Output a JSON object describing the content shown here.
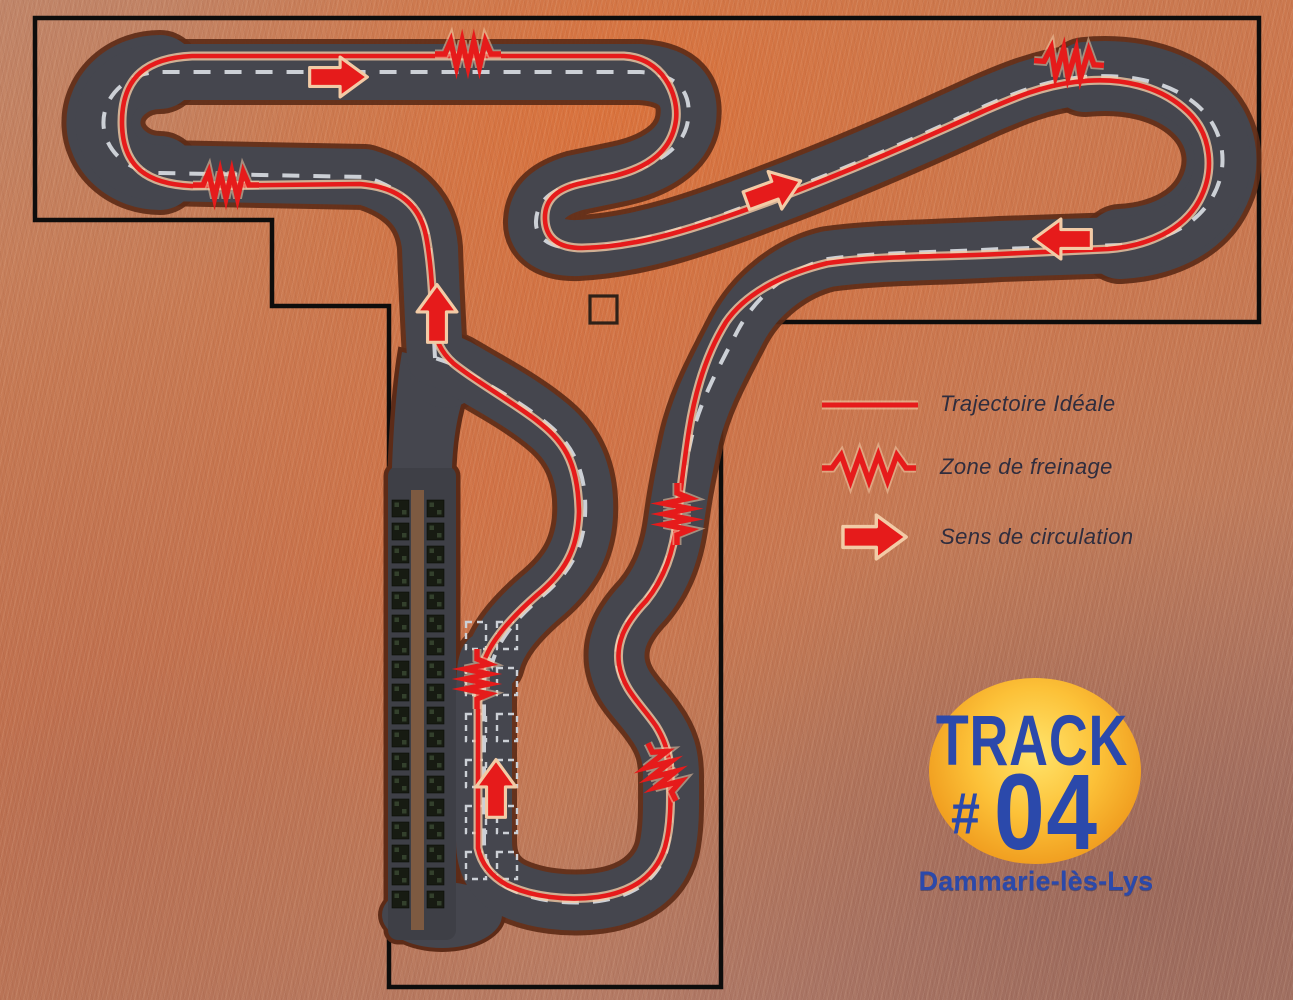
{
  "map": {
    "type": "karting-track-plan",
    "features": {
      "site_boundary": "black outline polygon",
      "track_surface": "dark asphalt circuit",
      "centerline": "white dashed line",
      "pit_area": "kart storage rows beside start straight",
      "start_grid": "dashed grid boxes on start straight",
      "marker_square": "small empty square outline near track center"
    }
  },
  "legend": {
    "items": [
      {
        "symbol": "red-line-icon",
        "label": "Trajectoire Idéale"
      },
      {
        "symbol": "zigzag-icon",
        "label": "Zone de freinage"
      },
      {
        "symbol": "arrow-icon",
        "label": "Sens de circulation"
      }
    ]
  },
  "logo": {
    "title": "TRACK",
    "number_sign": "#",
    "number": "04",
    "location": "Dammarie-lès-Lys"
  },
  "colors": {
    "racing_line": "#e61b1b",
    "racing_line_halo": "#f2cba6",
    "asphalt": "#45464e",
    "asphalt_edge": "#5d2b17",
    "centerline_dash": "#ccd0d6",
    "boundary": "#0e0d0c",
    "legend_text": "#2f2d3e",
    "logo_blue": "#2b49ab",
    "kart_dark": "#171b12",
    "kart_light": "#33402c",
    "pit_walkway": "#7d5a41",
    "marker_outline": "#2e2118"
  }
}
